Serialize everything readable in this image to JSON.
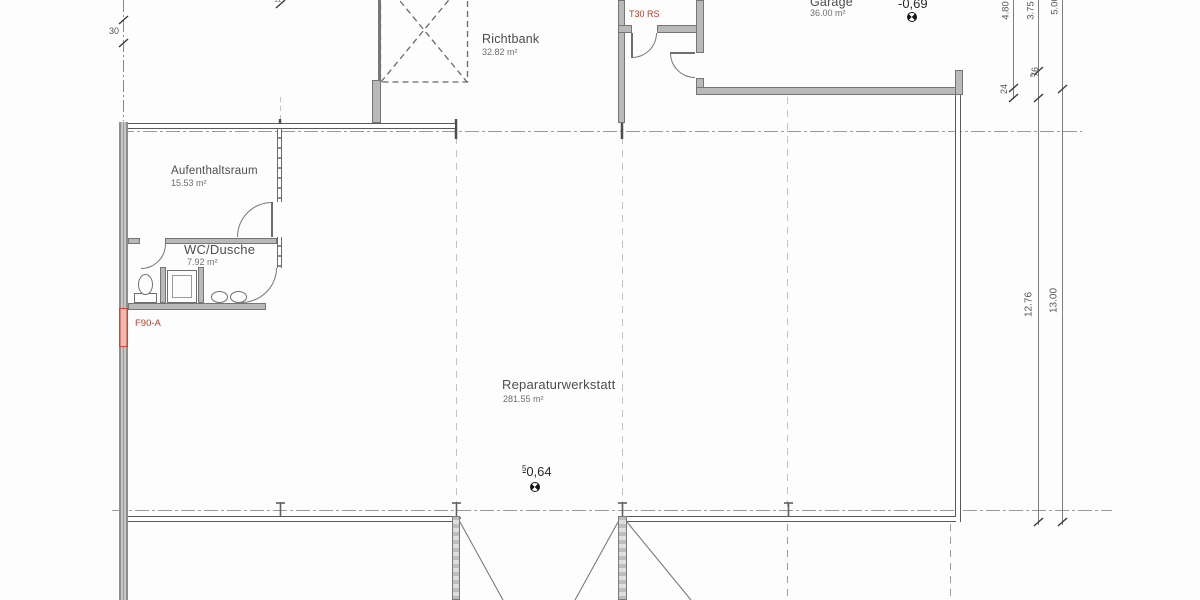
{
  "drawing_type": "floor-plan",
  "rooms": {
    "richtbank": {
      "name": "Richtbank",
      "area": "32.82 m²"
    },
    "garage": {
      "name": "Garage",
      "area": "36.00 m²"
    },
    "aufenthaltsraum": {
      "name": "Aufenthaltsraum",
      "area": "15.53 m²"
    },
    "wc": {
      "name": "WC/Dusche",
      "area": "7.92 m²"
    },
    "werkstatt": {
      "name": "Reparaturwerkstatt",
      "area": "281.55 m²"
    }
  },
  "fire_labels": {
    "door": "T30 RS",
    "wall": "F90-A"
  },
  "levels": {
    "garage": {
      "value": "-0,69",
      "sup": ""
    },
    "hall": {
      "value": "-0,64",
      "sup": "5"
    }
  },
  "dimensions": {
    "col1_upper": "4.80",
    "col1_small": "24",
    "col2_upper": "3.75",
    "col2_small": "76",
    "col2_small_sup": "5",
    "col2_main": "12.76",
    "col3_upper": "5.00",
    "col3_main": "13.00",
    "left_small": "30",
    "top_partial": "11"
  },
  "colors": {
    "fire_red": "#b63c2d",
    "wall_pink": "#f3b8ae",
    "wall_gray": "#b9b9b9",
    "line_gray": "#5a5a5a"
  }
}
